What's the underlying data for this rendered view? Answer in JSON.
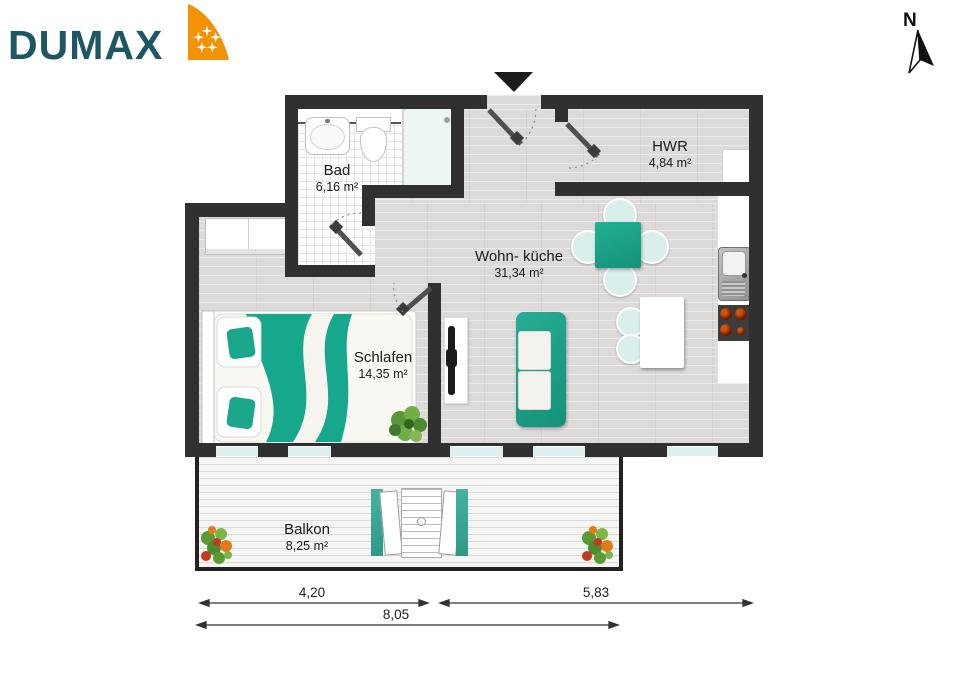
{
  "brand": {
    "name": "DUMAX"
  },
  "compass": {
    "label": "N"
  },
  "rooms": [
    {
      "name": "Bad",
      "area": "6,16 m²"
    },
    {
      "name": "HWR",
      "area": "4,84 m²"
    },
    {
      "name": "Wohn- küche",
      "area": "31,34 m²"
    },
    {
      "name": "Schlafen",
      "area": "14,35 m²"
    },
    {
      "name": "Balkon",
      "area": "8,25 m²"
    }
  ],
  "dimensions": {
    "balcony_width": "4,20",
    "right_width": "5,83",
    "total_width": "8,05"
  },
  "icons": {
    "north_arrow": "north-arrow",
    "entrance_arrow": "entrance-arrow",
    "stars": "logo-stars"
  },
  "colors": {
    "wall": "#303030",
    "furniture_teal": "#17a78c",
    "window": "#ddf1f0",
    "logo_text": "#1d5763",
    "logo_orange": "#f29204"
  }
}
